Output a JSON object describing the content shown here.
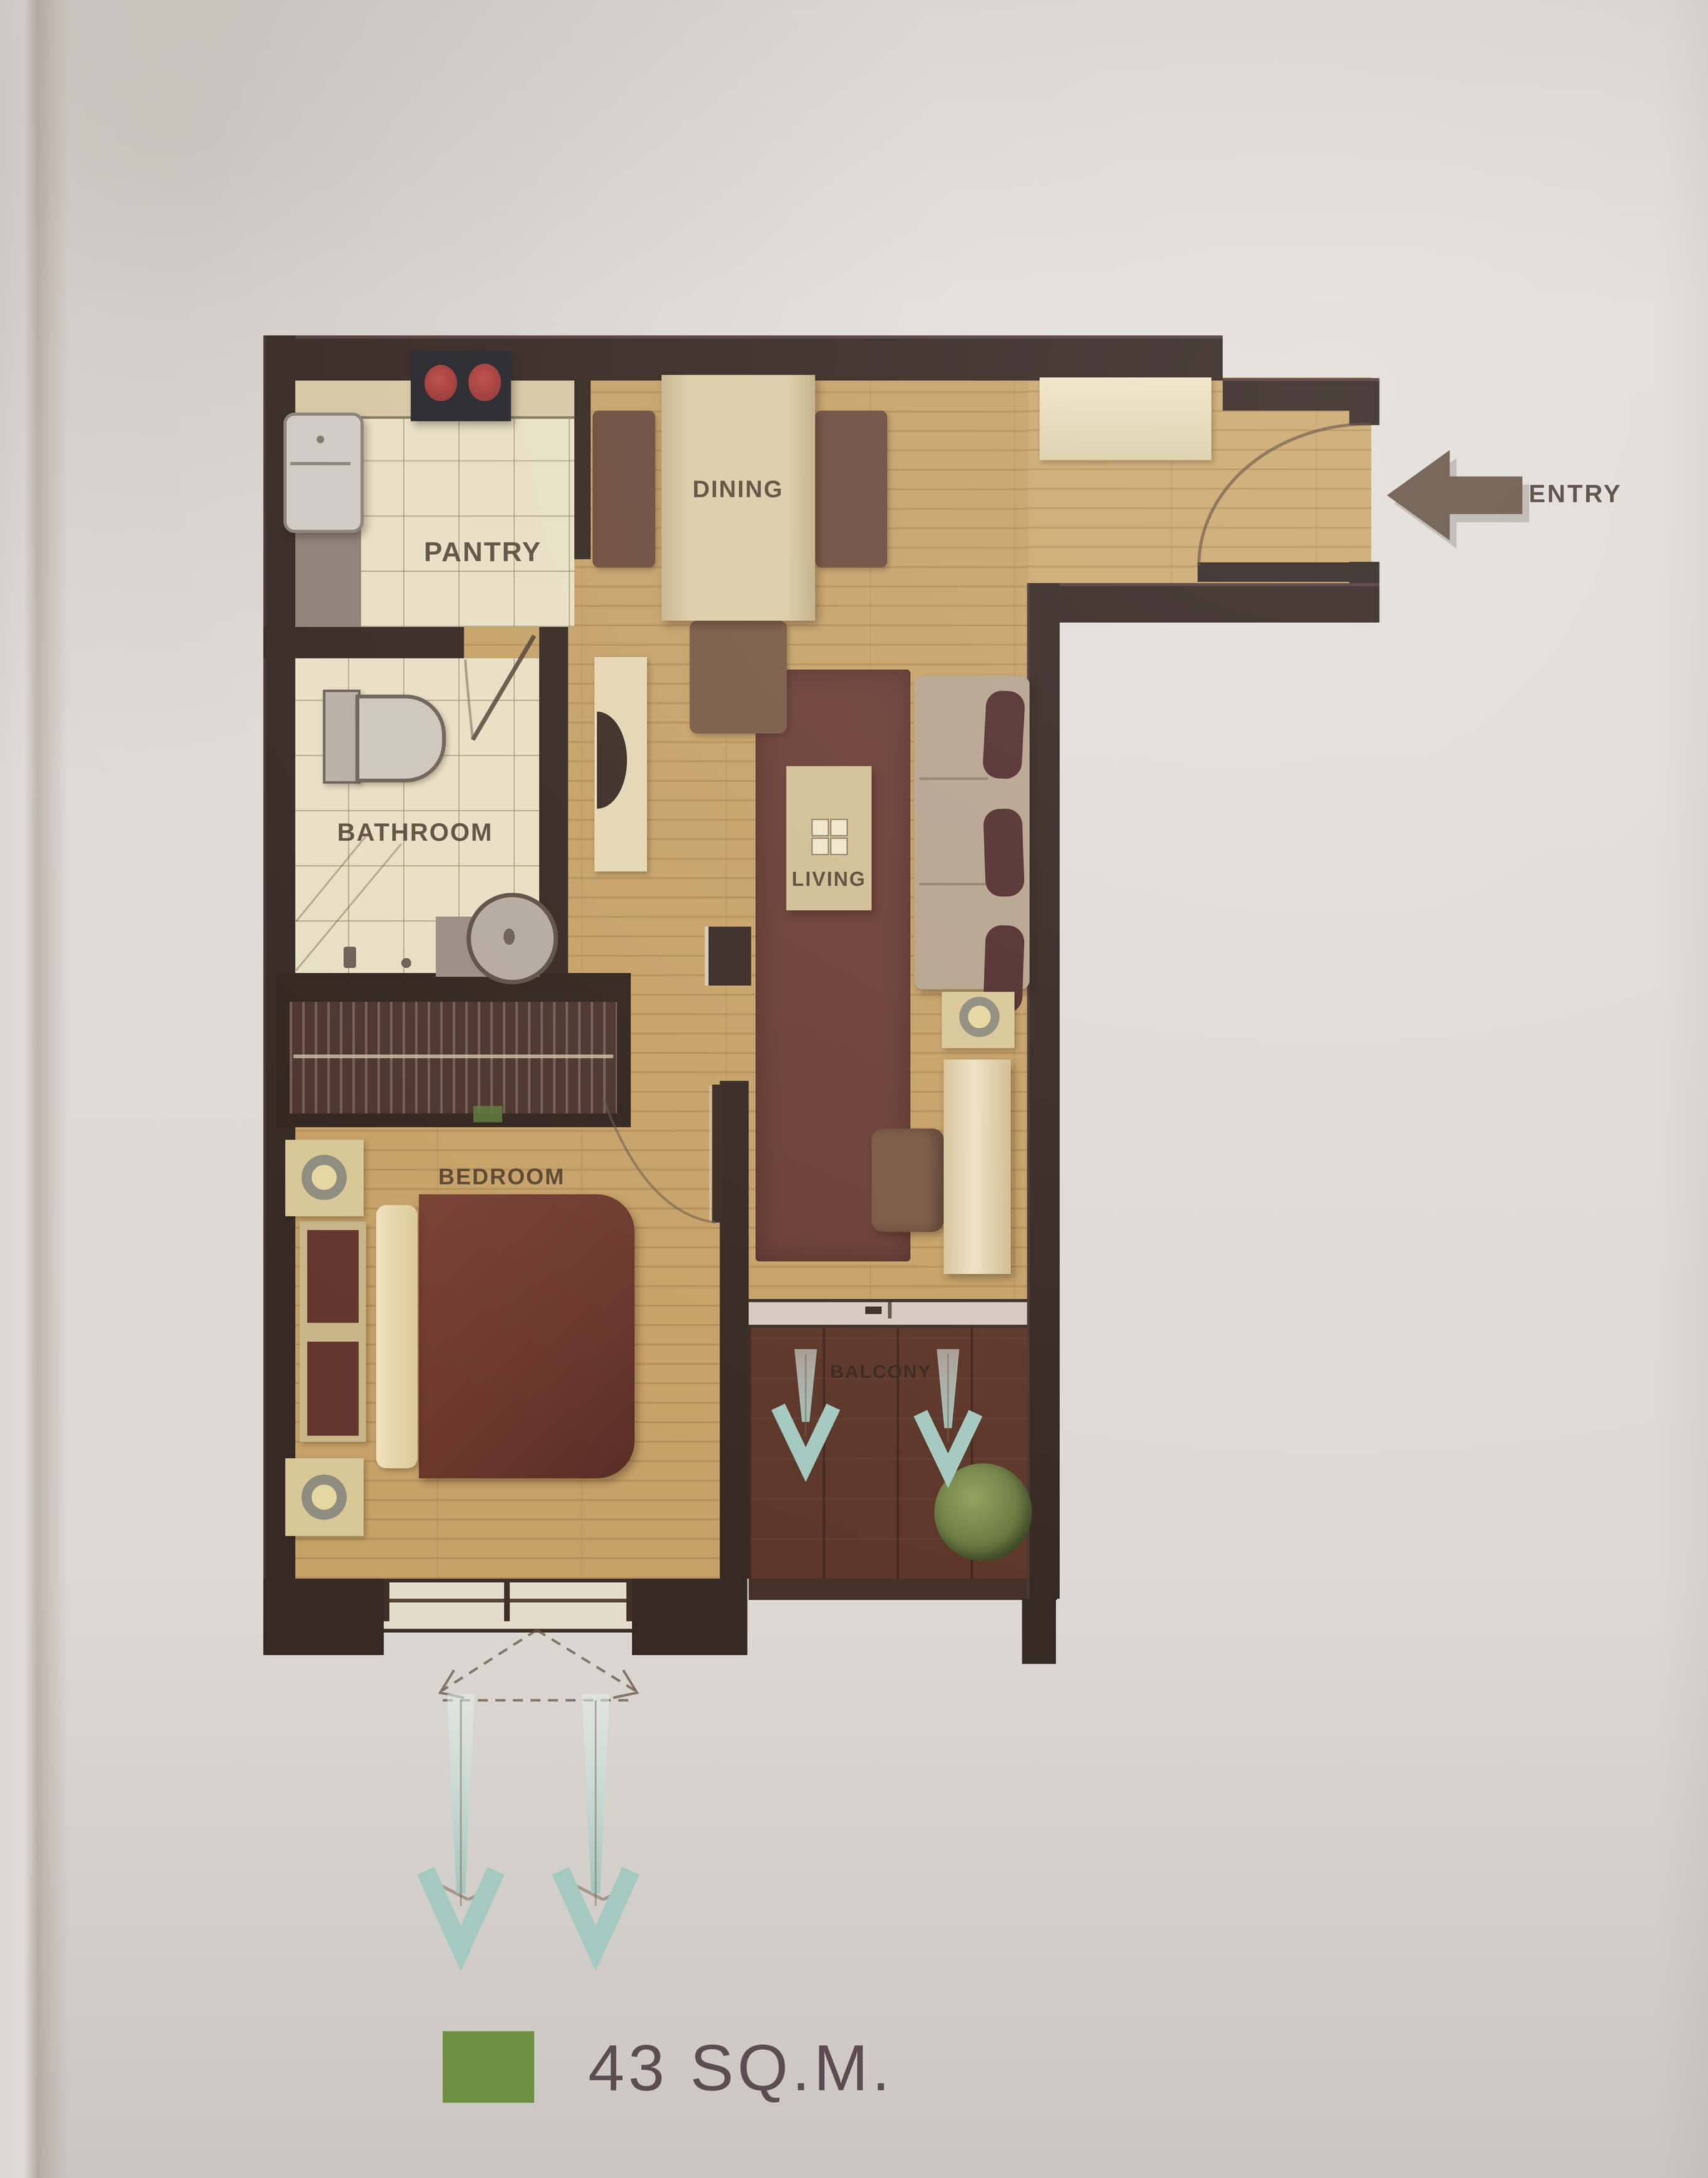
{
  "plan": {
    "rooms": {
      "dining": {
        "label": "DINING"
      },
      "pantry": {
        "label": "PANTRY"
      },
      "bathroom": {
        "label": "BATHROOM"
      },
      "living": {
        "label": "LIVING"
      },
      "bedroom": {
        "label": "BEDROOM"
      },
      "balcony": {
        "label": "BALCONY"
      }
    },
    "entry": {
      "label": "ENTRY"
    }
  },
  "legend": {
    "area_label": "43 SQ.M."
  },
  "colors": {
    "wall": "#362a24",
    "wood_floor": "#c7a265",
    "tile_floor": "#e7e0c3",
    "balcony_deck": "#5e3728",
    "living_rug": "#6c3f36",
    "legend_green": "#6d9140",
    "vent_arrow_teal": "#a3c9c0",
    "entry_arrow_brown": "#6d594b",
    "stove_burner_red": "#b03a3a"
  },
  "icons": {
    "entry_arrow": "◀",
    "vent_arrow": "▼"
  }
}
